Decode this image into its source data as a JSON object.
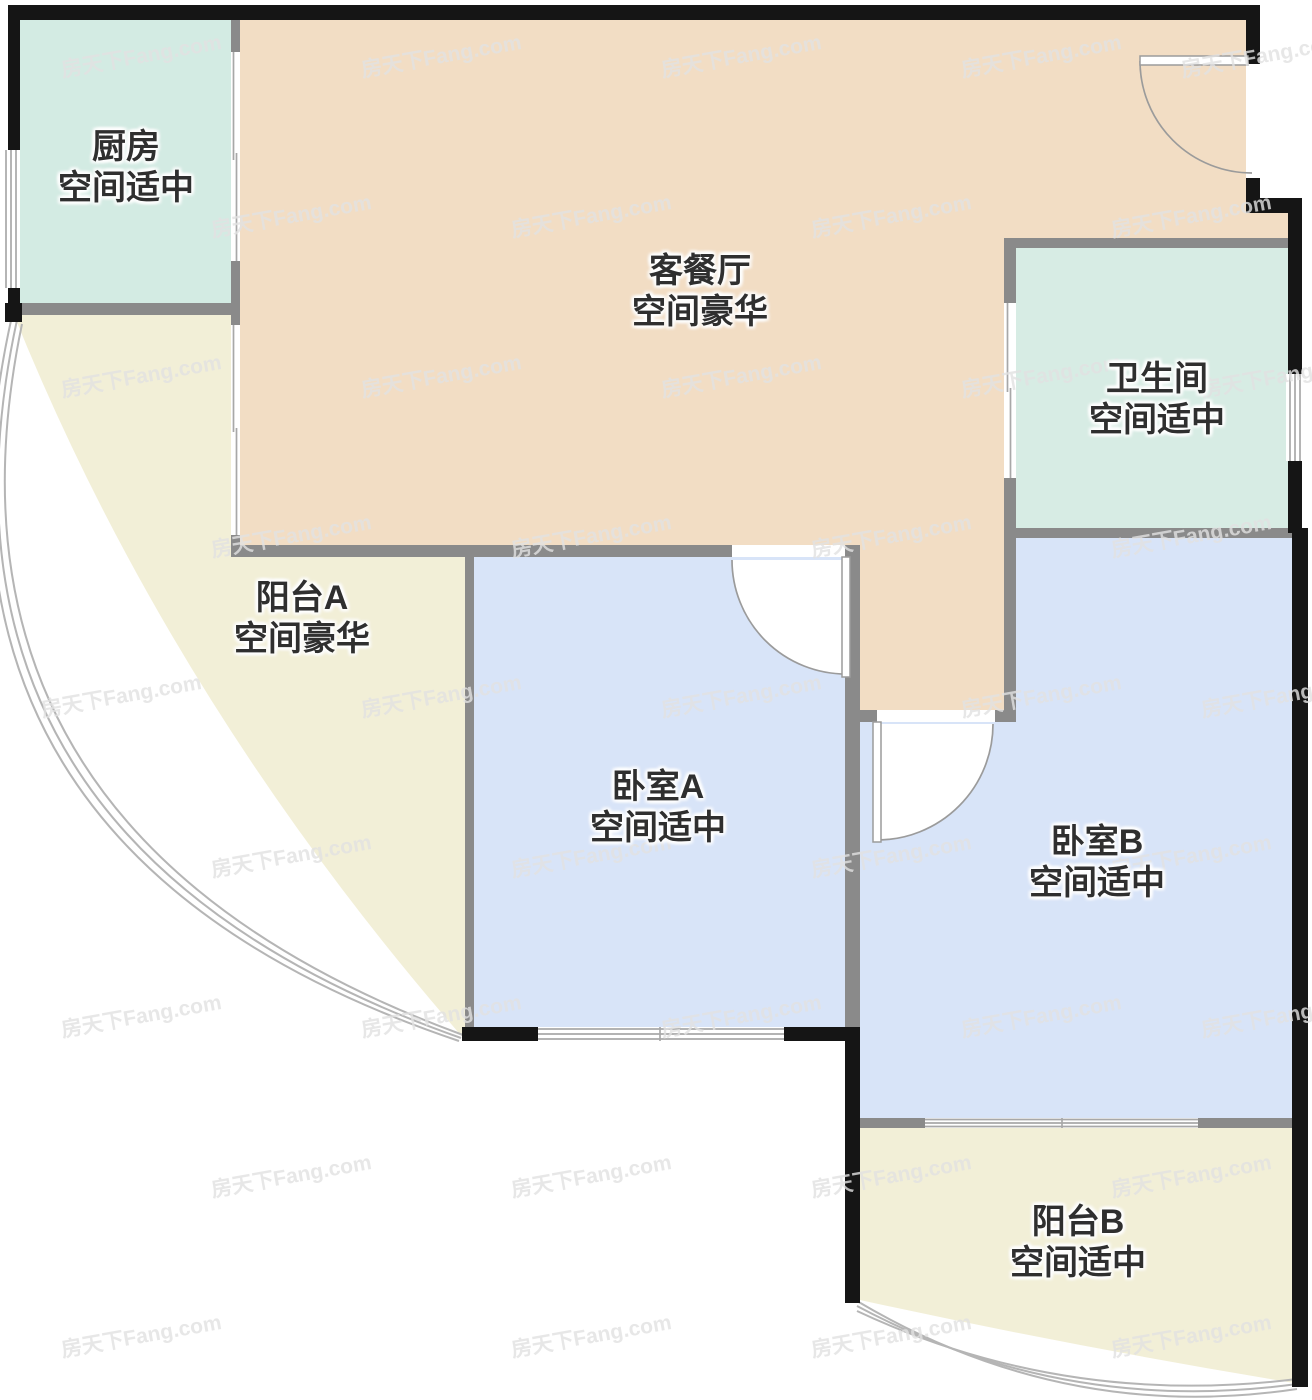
{
  "title": "户型图",
  "rooms": {
    "kitchen": {
      "name": "厨房",
      "size": "空间适中"
    },
    "living": {
      "name": "客餐厅",
      "size": "空间豪华"
    },
    "bathroom": {
      "name": "卫生间",
      "size": "空间适中"
    },
    "balcony_a": {
      "name": "阳台A",
      "size": "空间豪华"
    },
    "bedroom_a": {
      "name": "卧室A",
      "size": "空间适中"
    },
    "bedroom_b": {
      "name": "卧室B",
      "size": "空间适中"
    },
    "balcony_b": {
      "name": "阳台B",
      "size": "空间适中"
    }
  },
  "colors": {
    "living": "#f2ddc4",
    "kitchen": "#d3ebe3",
    "bathroom": "#d7ece4",
    "bedroom": "#d8e4f8",
    "balcony": "#f2efd7",
    "wall_black": "#151515",
    "wall_gray": "#8a8a8a",
    "label_text": "#2f2f2f",
    "watermark": "#e2e2e2"
  },
  "watermark": {
    "text": "房天下Fang.com",
    "positions": [
      [
        60,
        40
      ],
      [
        360,
        40
      ],
      [
        660,
        40
      ],
      [
        960,
        40
      ],
      [
        1180,
        40
      ],
      [
        210,
        200
      ],
      [
        510,
        200
      ],
      [
        810,
        200
      ],
      [
        1110,
        200
      ],
      [
        60,
        360
      ],
      [
        360,
        360
      ],
      [
        660,
        360
      ],
      [
        960,
        360
      ],
      [
        1200,
        360
      ],
      [
        210,
        520
      ],
      [
        510,
        520
      ],
      [
        810,
        520
      ],
      [
        1110,
        520
      ],
      [
        40,
        680
      ],
      [
        360,
        680
      ],
      [
        660,
        680
      ],
      [
        960,
        680
      ],
      [
        1200,
        680
      ],
      [
        210,
        840
      ],
      [
        510,
        840
      ],
      [
        810,
        840
      ],
      [
        1110,
        840
      ],
      [
        60,
        1000
      ],
      [
        360,
        1000
      ],
      [
        660,
        1000
      ],
      [
        960,
        1000
      ],
      [
        1200,
        1000
      ],
      [
        210,
        1160
      ],
      [
        510,
        1160
      ],
      [
        810,
        1160
      ],
      [
        1110,
        1160
      ],
      [
        60,
        1320
      ],
      [
        510,
        1320
      ],
      [
        810,
        1320
      ],
      [
        1110,
        1320
      ]
    ]
  }
}
